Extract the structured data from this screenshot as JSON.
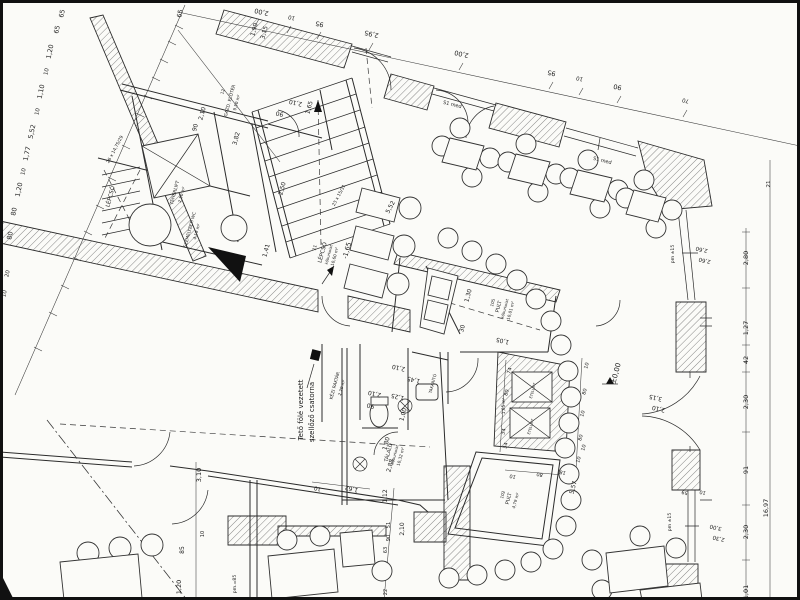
{
  "document": {
    "kind": "scanned architectural floor plan",
    "language": "Hungarian",
    "level_markers": [
      "±0,00",
      "-1,65"
    ],
    "overall_dimension": "16,97"
  },
  "colors": {
    "paper": "#fbfbf8",
    "ink": "#1c1c1c",
    "hatch": "#555555"
  },
  "rooms": [
    {
      "name": "LÉPCSŐ (szolgálati)",
      "note": "26 x 14,75/29"
    },
    {
      "name": "TEHERLIFT",
      "area": "2,50 m²"
    },
    {
      "name": "SZEMÉLYZETI WC",
      "area": "4,19 m²"
    },
    {
      "name": "GAZD. ELŐTÉR",
      "number": "12",
      "area": "9,50 m²"
    },
    {
      "name": "LÉPCSŐ",
      "number": "11",
      "area": "10,60 m²",
      "floor": "kőburkolat",
      "steps": "23 x 15/31",
      "level": "-1,65"
    },
    {
      "name": "KÉZI RAKTÁR",
      "area": "2,20 m²"
    },
    {
      "name": "TÁLALÓ",
      "area": "10,32 m²",
      "floor": "kőburkolat"
    },
    {
      "name": "TAKARÍTÓ"
    },
    {
      "name": "PULT",
      "number": "105",
      "area": "10,01 m²",
      "floor": "kőburkolat"
    },
    {
      "name": "PULT",
      "number": "102",
      "area": "4,79 m²"
    },
    {
      "name": "ÉTELLIFT",
      "area": "1,65 m²"
    }
  ],
  "note_vertical": [
    "Tető fölé vezetett",
    "szellőző csatorna"
  ],
  "window_codes": [
    "S1 med"
  ],
  "annotations": [
    {
      "t": "65",
      "x": 64,
      "y": 14,
      "r": -78
    },
    {
      "t": "65",
      "x": 59,
      "y": 30,
      "r": -78
    },
    {
      "t": "1,20",
      "x": 52,
      "y": 52,
      "r": -78
    },
    {
      "t": "10",
      "x": 48,
      "y": 72,
      "r": -78,
      "s": 5.5
    },
    {
      "t": "1,10",
      "x": 43,
      "y": 92,
      "r": -78
    },
    {
      "t": "10",
      "x": 39,
      "y": 112,
      "r": -78,
      "s": 5.5
    },
    {
      "t": "5,52",
      "x": 34,
      "y": 132,
      "r": -78
    },
    {
      "t": "1,77",
      "x": 29,
      "y": 154,
      "r": -78
    },
    {
      "t": "10",
      "x": 25,
      "y": 172,
      "r": -78,
      "s": 5.5
    },
    {
      "t": "1,20",
      "x": 21,
      "y": 190,
      "r": -78
    },
    {
      "t": "80",
      "x": 16,
      "y": 212,
      "r": -78
    },
    {
      "t": "80",
      "x": 12,
      "y": 236,
      "r": -78
    },
    {
      "t": "20",
      "x": 9,
      "y": 274,
      "r": -78,
      "s": 5.5
    },
    {
      "t": "10",
      "x": 6,
      "y": 294,
      "r": -78,
      "s": 5.5
    },
    {
      "t": "65",
      "x": 182,
      "y": 14,
      "r": -78
    },
    {
      "t": "2,00",
      "x": 262,
      "y": 10,
      "r": 193
    },
    {
      "t": "10",
      "x": 292,
      "y": 16,
      "r": 193,
      "s": 5.5
    },
    {
      "t": "95",
      "x": 320,
      "y": 22,
      "r": 193
    },
    {
      "t": "2,95",
      "x": 372,
      "y": 32,
      "r": 193
    },
    {
      "t": "2,00",
      "x": 462,
      "y": 52,
      "r": 193
    },
    {
      "t": "95",
      "x": 552,
      "y": 71,
      "r": 193
    },
    {
      "t": "10",
      "x": 580,
      "y": 77,
      "r": 193,
      "s": 5.5
    },
    {
      "t": "90",
      "x": 618,
      "y": 85,
      "r": 193
    },
    {
      "t": "70",
      "x": 686,
      "y": 99,
      "r": 193,
      "s": 5.5
    },
    {
      "t": "1,90",
      "x": 256,
      "y": 30,
      "r": -75,
      "s": 6
    },
    {
      "t": "3,15",
      "x": 266,
      "y": 33,
      "r": -75,
      "s": 6
    },
    {
      "t": "2,10",
      "x": 296,
      "y": 101,
      "r": 193,
      "s": 6
    },
    {
      "t": "90",
      "x": 280,
      "y": 112,
      "r": 193,
      "s": 6
    },
    {
      "t": "1,65",
      "x": 311,
      "y": 108,
      "r": -75,
      "s": 6
    },
    {
      "t": "2,10",
      "x": 204,
      "y": 114,
      "r": -75,
      "s": 6
    },
    {
      "t": "90",
      "x": 197,
      "y": 128,
      "r": -75,
      "s": 6
    },
    {
      "t": "3,82",
      "x": 238,
      "y": 139,
      "r": -75,
      "s": 6
    },
    {
      "t": "S1 med",
      "x": 452,
      "y": 106,
      "r": 14,
      "s": 5,
      "n": "window-code"
    },
    {
      "t": "S1 med",
      "x": 602,
      "y": 162,
      "r": 14,
      "s": 5,
      "n": "window-code"
    },
    {
      "t": "2,80",
      "x": 748,
      "y": 258,
      "r": -90
    },
    {
      "t": "1,27",
      "x": 748,
      "y": 328,
      "r": -90
    },
    {
      "t": "42",
      "x": 748,
      "y": 360,
      "r": -90
    },
    {
      "t": "2,30",
      "x": 748,
      "y": 402,
      "r": -90
    },
    {
      "t": "91",
      "x": 748,
      "y": 470,
      "r": -90
    },
    {
      "t": "2,30",
      "x": 748,
      "y": 532,
      "r": -90
    },
    {
      "t": "1,01",
      "x": 748,
      "y": 592,
      "r": -90
    },
    {
      "t": "16,97",
      "x": 768,
      "y": 508,
      "r": -90
    },
    {
      "t": "21",
      "x": 770,
      "y": 184,
      "r": -90,
      "s": 5.5
    },
    {
      "t": "2,60",
      "x": 702,
      "y": 248,
      "r": 193,
      "s": 5.5
    },
    {
      "t": "2,60",
      "x": 705,
      "y": 259,
      "r": 193,
      "s": 5.5
    },
    {
      "t": "pm ±15",
      "x": 674,
      "y": 254,
      "r": -90,
      "s": 4.6
    },
    {
      "t": "3,15",
      "x": 656,
      "y": 396,
      "r": 193,
      "s": 6
    },
    {
      "t": "2,10",
      "x": 659,
      "y": 407,
      "r": 193,
      "s": 6
    },
    {
      "t": "59",
      "x": 685,
      "y": 491,
      "r": 193,
      "s": 5
    },
    {
      "t": "10",
      "x": 703,
      "y": 491,
      "r": 193,
      "s": 5
    },
    {
      "t": "pm ±15",
      "x": 671,
      "y": 522,
      "r": -90,
      "s": 4.6
    },
    {
      "t": "3,00",
      "x": 716,
      "y": 526,
      "r": 193,
      "s": 5.5
    },
    {
      "t": "2,30",
      "x": 719,
      "y": 537,
      "r": 193,
      "s": 5.5
    },
    {
      "t": "1,41",
      "x": 268,
      "y": 251,
      "r": -75,
      "s": 6
    },
    {
      "t": "2,50",
      "x": 284,
      "y": 189,
      "r": -75,
      "s": 6
    },
    {
      "t": "23 x 15/31",
      "x": 340,
      "y": 196,
      "r": -62,
      "s": 4.4
    },
    {
      "t": "26 x 14,75/29",
      "x": 116,
      "y": 150,
      "r": -62,
      "s": 4.4
    },
    {
      "t": "5,52",
      "x": 392,
      "y": 208,
      "r": -62,
      "s": 6
    },
    {
      "t": "2,10",
      "x": 375,
      "y": 392,
      "r": 193,
      "s": 6
    },
    {
      "t": "90",
      "x": 371,
      "y": 404,
      "r": 193,
      "s": 6
    },
    {
      "t": "1,25",
      "x": 398,
      "y": 395,
      "r": 193,
      "s": 6
    },
    {
      "t": "2,10",
      "x": 399,
      "y": 366,
      "r": 193,
      "s": 6
    },
    {
      "t": "1,45",
      "x": 414,
      "y": 378,
      "r": 193,
      "s": 6
    },
    {
      "t": "1,00",
      "x": 405,
      "y": 415,
      "r": -75,
      "s": 6
    },
    {
      "t": "1,80",
      "x": 388,
      "y": 444,
      "r": -75,
      "s": 6
    },
    {
      "t": "2,88",
      "x": 392,
      "y": 466,
      "r": -75,
      "s": 6
    },
    {
      "t": "1,05",
      "x": 503,
      "y": 339,
      "r": 193,
      "s": 6
    },
    {
      "t": "1,30",
      "x": 470,
      "y": 296,
      "r": -75,
      "s": 6
    },
    {
      "t": "30",
      "x": 464,
      "y": 329,
      "r": -75,
      "s": 6
    },
    {
      "t": "10",
      "x": 318,
      "y": 487,
      "r": 193,
      "s": 5.5
    },
    {
      "t": "1,62",
      "x": 352,
      "y": 487,
      "r": 193,
      "s": 6
    },
    {
      "t": "1,12",
      "x": 387,
      "y": 496,
      "r": -90,
      "s": 6
    },
    {
      "t": "51",
      "x": 390,
      "y": 525,
      "r": -90,
      "s": 5
    },
    {
      "t": "90",
      "x": 390,
      "y": 538,
      "r": -90,
      "s": 5
    },
    {
      "t": "63",
      "x": 387,
      "y": 550,
      "r": -90,
      "s": 5
    },
    {
      "t": "22",
      "x": 387,
      "y": 592,
      "r": -90,
      "s": 5
    },
    {
      "t": "2,10",
      "x": 404,
      "y": 529,
      "r": -90,
      "s": 6
    },
    {
      "t": "pm.=85",
      "x": 236,
      "y": 584,
      "r": -90,
      "s": 4.6
    },
    {
      "t": "3,10",
      "x": 201,
      "y": 475,
      "r": -90,
      "s": 6.5
    },
    {
      "t": "10",
      "x": 204,
      "y": 534,
      "r": -90,
      "s": 5
    },
    {
      "t": "85",
      "x": 184,
      "y": 550,
      "r": -90,
      "s": 6
    },
    {
      "t": "1,20",
      "x": 181,
      "y": 587,
      "r": -90,
      "s": 6.5
    },
    {
      "t": "34",
      "x": 507,
      "y": 446,
      "r": -75,
      "s": 5
    },
    {
      "t": "10",
      "x": 513,
      "y": 475,
      "r": 193,
      "s": 5
    },
    {
      "t": "80",
      "x": 540,
      "y": 473,
      "r": 193,
      "s": 5
    },
    {
      "t": "18",
      "x": 563,
      "y": 471,
      "r": 193,
      "s": 5
    },
    {
      "t": "5,57",
      "x": 575,
      "y": 488,
      "r": -75,
      "s": 6
    },
    {
      "t": "10",
      "x": 585,
      "y": 448,
      "r": -75,
      "s": 5
    },
    {
      "t": "74",
      "x": 511,
      "y": 371,
      "r": -75,
      "s": 5
    },
    {
      "t": "80",
      "x": 508,
      "y": 393,
      "r": -75,
      "s": 5
    },
    {
      "t": "34",
      "x": 505,
      "y": 432,
      "r": -75,
      "s": 5
    },
    {
      "t": "10",
      "x": 588,
      "y": 366,
      "r": -75,
      "s": 5
    },
    {
      "t": "80",
      "x": 586,
      "y": 392,
      "r": -75,
      "s": 5
    },
    {
      "t": "10",
      "x": 584,
      "y": 414,
      "r": -75,
      "s": 5
    },
    {
      "t": "80",
      "x": 582,
      "y": 438,
      "r": -75,
      "s": 5
    },
    {
      "t": "10",
      "x": 580,
      "y": 460,
      "r": -75,
      "s": 5
    },
    {
      "t": "LÉPCSŐ",
      "x": 112,
      "y": 197,
      "r": -75,
      "s": 5.5,
      "n": "room-label"
    },
    {
      "t": "TEHERLIFT",
      "x": 176,
      "y": 193,
      "r": -75,
      "s": 4.6,
      "n": "room-label"
    },
    {
      "t": "2,50 m²",
      "x": 183,
      "y": 195,
      "r": -75,
      "s": 4.2,
      "n": "room-area"
    },
    {
      "t": "SZEMÉLYZETI WC",
      "x": 191,
      "y": 230,
      "r": -75,
      "s": 4.2,
      "n": "room-label"
    },
    {
      "t": "4,19 m²",
      "x": 198,
      "y": 232,
      "r": -75,
      "s": 4.2,
      "n": "room-area"
    },
    {
      "t": "12",
      "x": 224,
      "y": 92,
      "r": -75,
      "s": 4.2,
      "n": "room-number"
    },
    {
      "t": "GAZD. ELŐTÉR",
      "x": 231,
      "y": 101,
      "r": -75,
      "s": 4.4,
      "n": "room-label"
    },
    {
      "t": "9,50 m²",
      "x": 238,
      "y": 103,
      "r": -75,
      "s": 4.2,
      "n": "room-area"
    },
    {
      "t": "11",
      "x": 316,
      "y": 248,
      "r": -75,
      "s": 4.4,
      "n": "room-number"
    },
    {
      "t": "LÉPCSŐ",
      "x": 324,
      "y": 253,
      "r": -75,
      "s": 5.4,
      "n": "room-label"
    },
    {
      "t": "kőburkolat",
      "x": 330,
      "y": 255,
      "r": -75,
      "s": 3.8,
      "n": "room-floor"
    },
    {
      "t": "10,60 m²",
      "x": 336,
      "y": 257,
      "r": -75,
      "s": 4.2,
      "n": "room-area"
    },
    {
      "t": "-1,65",
      "x": 349,
      "y": 251,
      "r": -75,
      "s": 6.5,
      "n": "level-marker"
    },
    {
      "t": "Tető fölé vezetett",
      "x": 303,
      "y": 410,
      "r": -90,
      "s": 7,
      "n": "note-vent-duct"
    },
    {
      "t": "szellőző csatorna",
      "x": 314,
      "y": 412,
      "r": -90,
      "s": 7,
      "n": "note-vent-duct"
    },
    {
      "t": "KÉZI RAKTÁR",
      "x": 336,
      "y": 386,
      "r": -75,
      "s": 4.4,
      "n": "room-label"
    },
    {
      "t": "2,20 m²",
      "x": 343,
      "y": 388,
      "r": -75,
      "s": 4.2,
      "n": "room-area"
    },
    {
      "t": "TÁLALÓ",
      "x": 390,
      "y": 453,
      "r": -75,
      "s": 5,
      "n": "room-label"
    },
    {
      "t": "kőburkolat",
      "x": 396,
      "y": 455,
      "r": -75,
      "s": 3.8,
      "n": "room-floor"
    },
    {
      "t": "10,32 m²",
      "x": 402,
      "y": 457,
      "r": -75,
      "s": 4.2,
      "n": "room-area"
    },
    {
      "t": "TAKARÍTÓ",
      "x": 434,
      "y": 384,
      "r": -75,
      "s": 4,
      "n": "room-label"
    },
    {
      "t": "105",
      "x": 494,
      "y": 303,
      "r": -75,
      "s": 4.2,
      "n": "room-number"
    },
    {
      "t": "PULT",
      "x": 500,
      "y": 307,
      "r": -75,
      "s": 5,
      "n": "room-label"
    },
    {
      "t": "kőburkolat",
      "x": 506,
      "y": 309,
      "r": -75,
      "s": 3.8,
      "n": "room-floor"
    },
    {
      "t": "10,01 m²",
      "x": 512,
      "y": 311,
      "r": -75,
      "s": 4.2,
      "n": "room-area"
    },
    {
      "t": "102",
      "x": 504,
      "y": 495,
      "r": -75,
      "s": 4.2,
      "n": "room-number"
    },
    {
      "t": "PULT",
      "x": 510,
      "y": 499,
      "r": -75,
      "s": 5,
      "n": "room-label"
    },
    {
      "t": "4,79 m²",
      "x": 517,
      "y": 501,
      "r": -75,
      "s": 4.2,
      "n": "room-area"
    },
    {
      "t": "ÉTELLIFT",
      "x": 534,
      "y": 391,
      "r": -75,
      "s": 3.6,
      "n": "room-label"
    },
    {
      "t": "ÉTELLIFT",
      "x": 532,
      "y": 427,
      "r": -75,
      "s": 3.6,
      "n": "room-label"
    },
    {
      "t": "1,65 m²",
      "x": 505,
      "y": 406,
      "r": -90,
      "s": 4.2,
      "n": "room-area"
    },
    {
      "t": "±0,00",
      "x": 618,
      "y": 374,
      "r": -75,
      "s": 7,
      "n": "level-marker"
    }
  ]
}
